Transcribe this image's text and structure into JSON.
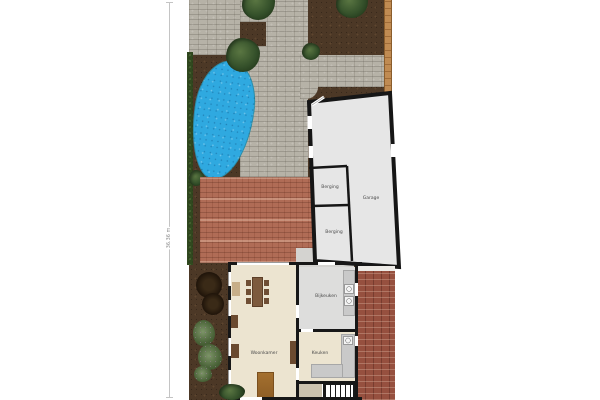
{
  "plan": {
    "dimension_label": "36.36 m",
    "rooms": {
      "berging_top": "Berging",
      "garage": "Garage",
      "berging_bottom": "Berging",
      "bijkeuken": "Bijkeuken",
      "keuken": "Keuken",
      "woonkamer": "Woonkamer"
    },
    "colors": {
      "paving": "#b6b2a7",
      "soil": "#4c3826",
      "pond": "#2fa9e0",
      "hedge": "#31491f",
      "terrace_tiles": "#b06c56",
      "brick_path": "#96503f",
      "fence": "#c08b52",
      "wall": "#171717",
      "garage_floor": "#e6e6e6",
      "house_floor": "#ece4d0",
      "utility_floor": "#dddddc"
    }
  }
}
